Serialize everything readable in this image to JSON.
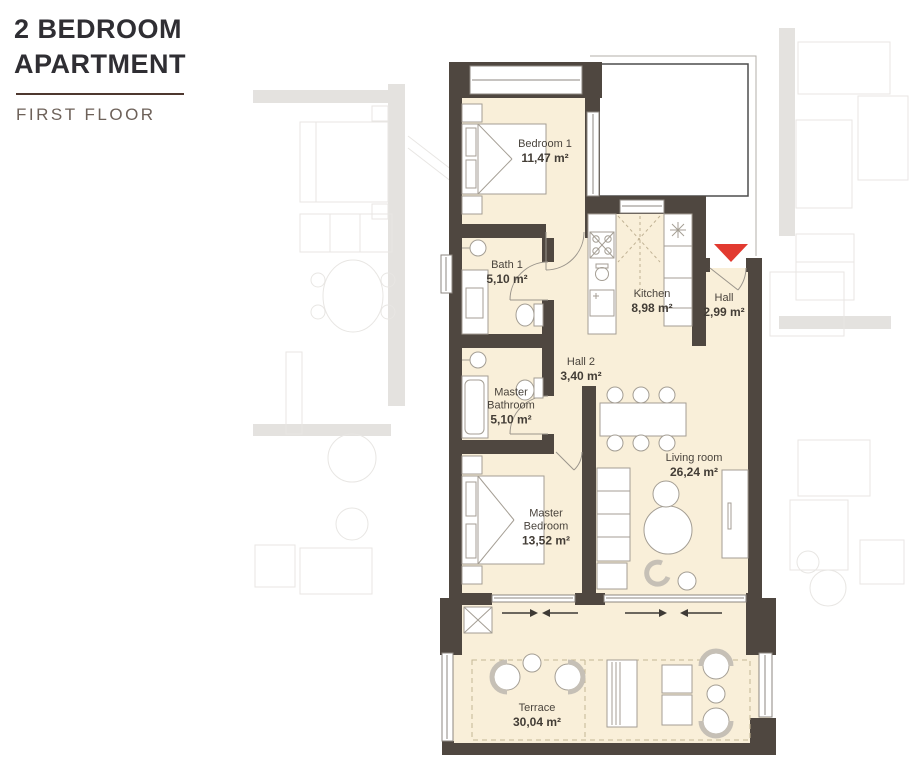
{
  "header": {
    "title": "2 BEDROOM APARTMENT",
    "subtitle": "FIRST FLOOR"
  },
  "colors": {
    "wall": "#4f4740",
    "room_fill": "#f9efd9",
    "entrance_accent": "#e23a30",
    "title_text": "#2f2e33",
    "subtitle_text": "#6d6159",
    "divider": "#4e382f",
    "label_text": "#4a443d"
  },
  "icons": {
    "entrance_marker": "red-triangle-down"
  },
  "rooms": {
    "bedroom1": {
      "name": "Bedroom 1",
      "area": "11,47 m²"
    },
    "bath1": {
      "name": "Bath 1",
      "area": "5,10 m²"
    },
    "kitchen": {
      "name": "Kitchen",
      "area": "8,98 m²"
    },
    "hall": {
      "name": "Hall",
      "area": "2,99 m²"
    },
    "hall2": {
      "name": "Hall 2",
      "area": "3,40 m²"
    },
    "master_bathroom": {
      "name": "Master Bathroom",
      "area": "5,10 m²"
    },
    "master_bedroom": {
      "name": "Master Bedroom",
      "area": "13,52 m²"
    },
    "living_room": {
      "name": "Living room",
      "area": "26,24 m²"
    },
    "terrace": {
      "name": "Terrace",
      "area": "30,04 m²"
    }
  }
}
